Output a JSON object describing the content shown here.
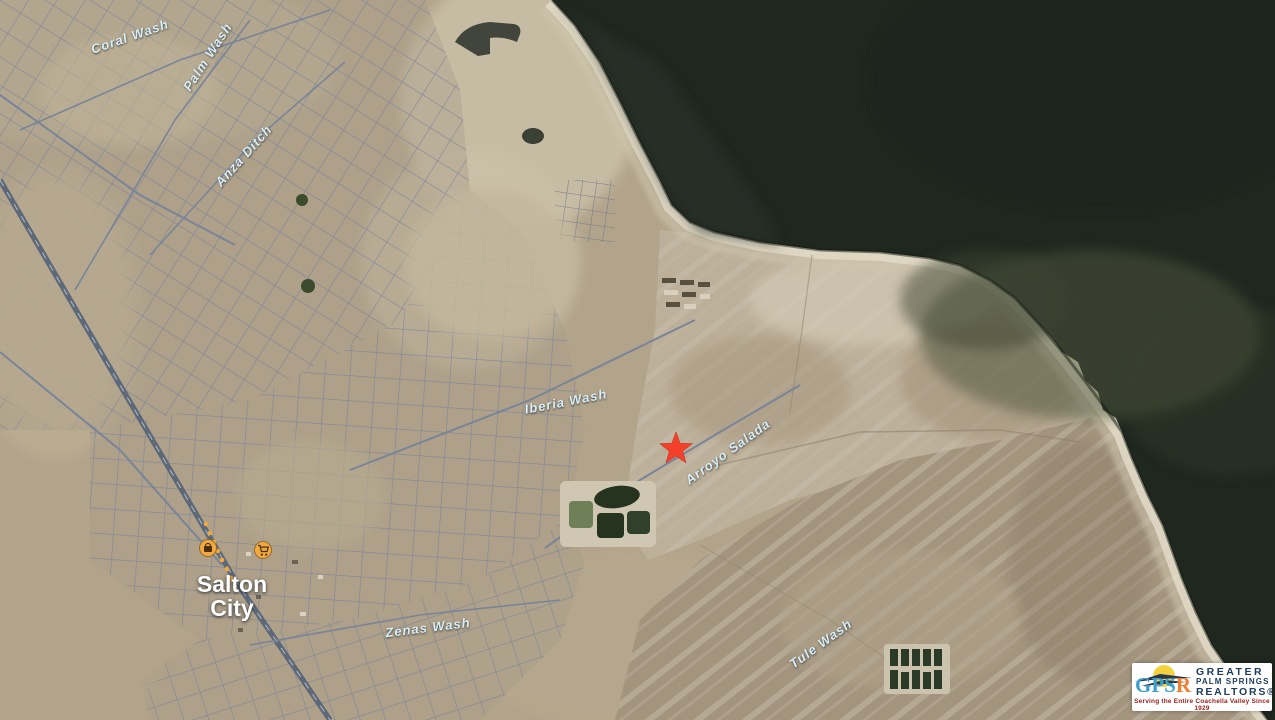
{
  "map": {
    "type": "satellite-aerial",
    "place_labels": {
      "city": {
        "line1": "Salton",
        "line2": "City"
      },
      "washes": {
        "coral": "Coral Wash",
        "palm": "Palm Wash",
        "anza": "Anza Ditch",
        "iberia": "Iberia Wash",
        "arroyo": "Arroyo Salada",
        "zenas": "Zenas Wash",
        "tule": "Tule Wash"
      }
    },
    "marker": {
      "shape": "red-star",
      "color": "#f2402a"
    },
    "poi_icons": [
      {
        "name": "convenience-store-icon",
        "color": "#efa93f"
      },
      {
        "name": "shopping-cart-icon",
        "color": "#efa93f"
      }
    ],
    "colors": {
      "water": "#1f271f",
      "land": "#b2a48b",
      "roads": "#79849a",
      "beach": "#e0d9c5",
      "badlands": "#a3947e",
      "label_text": "#d9edf5"
    }
  },
  "logo": {
    "acronym_blue": "GPS",
    "acronym_orange": "R",
    "name_line1": "GREATER",
    "name_line2": "PALM SPRINGS",
    "name_line3": "REALTORS®",
    "tagline": "Serving the Entire Coachella Valley Since 1929"
  }
}
